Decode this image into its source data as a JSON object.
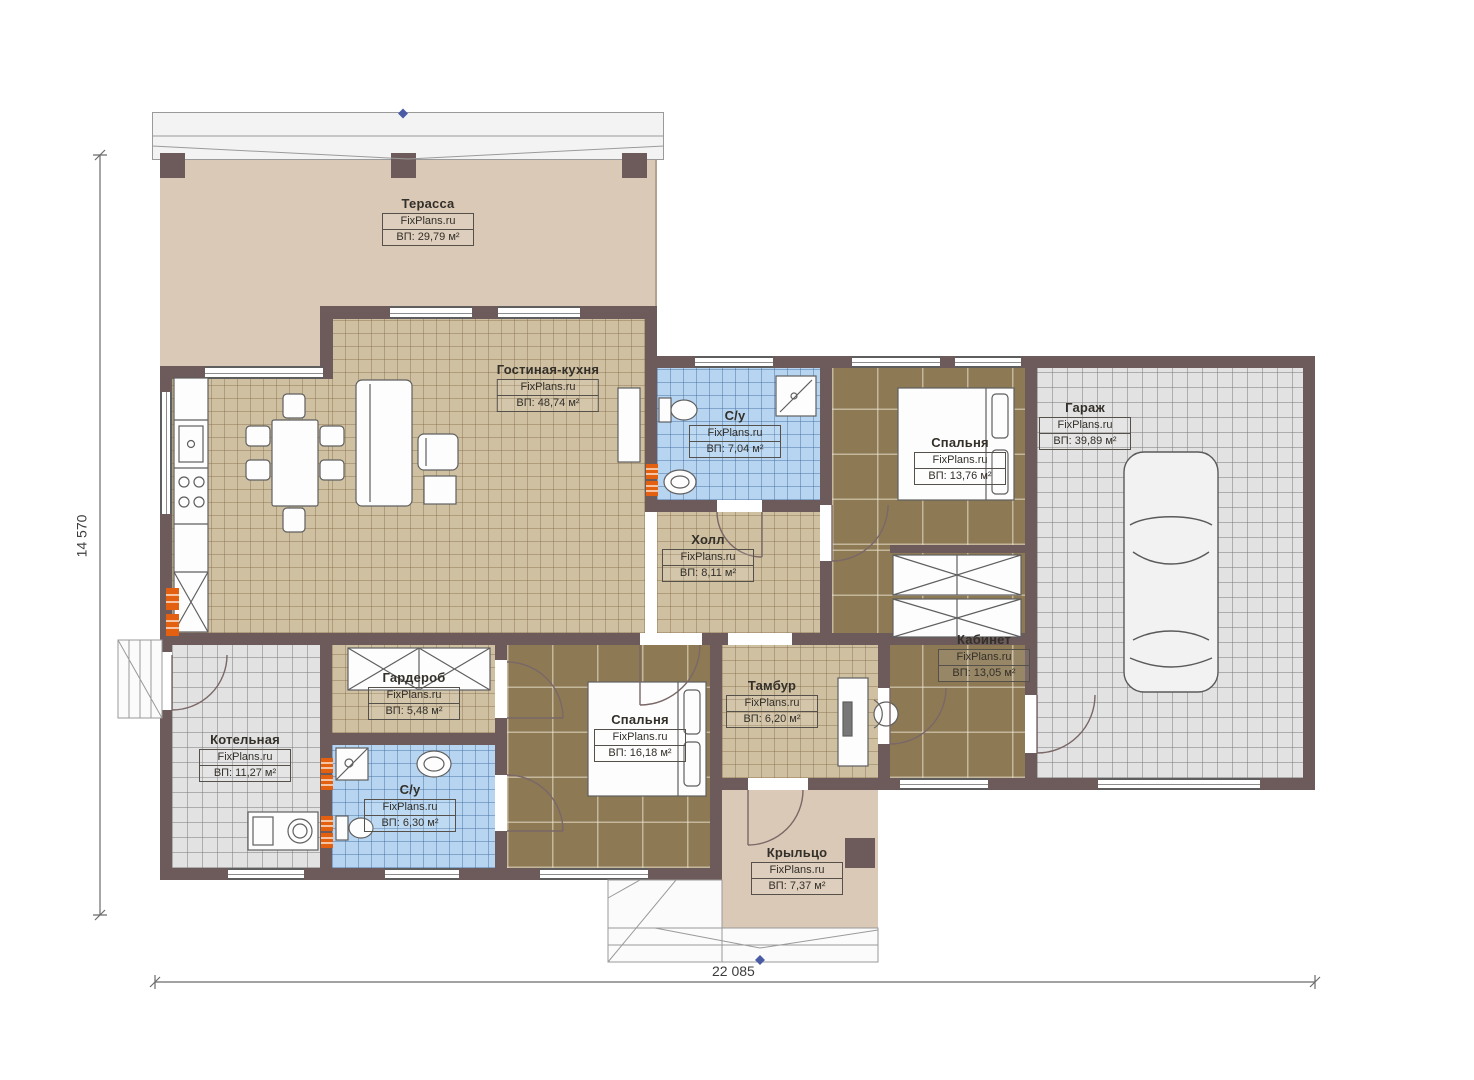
{
  "plan": {
    "watermark": "FixPlans.ru",
    "rooms": [
      {
        "id": "terrace",
        "name": "Терасса",
        "area": "ВП: 29,79 м²"
      },
      {
        "id": "living",
        "name": "Гостиная-кухня",
        "area": "ВП: 48,74 м²"
      },
      {
        "id": "bath1",
        "name": "С/у",
        "area": "ВП: 7,04 м²"
      },
      {
        "id": "bedroom1",
        "name": "Спальня",
        "area": "ВП: 13,76 м²"
      },
      {
        "id": "garage",
        "name": "Гараж",
        "area": "ВП: 39,89 м²"
      },
      {
        "id": "hall",
        "name": "Холл",
        "area": "ВП: 8,11 м²"
      },
      {
        "id": "wardrobe",
        "name": "Гардероб",
        "area": "ВП: 5,48 м²"
      },
      {
        "id": "boiler",
        "name": "Котельная",
        "area": "ВП: 11,27 м²"
      },
      {
        "id": "bath2",
        "name": "С/у",
        "area": "ВП: 6,30 м²"
      },
      {
        "id": "bedroom2",
        "name": "Спальня",
        "area": "ВП: 16,18 м²"
      },
      {
        "id": "tambour",
        "name": "Тамбур",
        "area": "ВП: 6,20 м²"
      },
      {
        "id": "office",
        "name": "Кабинет",
        "area": "ВП: 13,05 м²"
      },
      {
        "id": "porch",
        "name": "Крыльцо",
        "area": "ВП: 7,37 м²"
      }
    ],
    "dimensions": {
      "height_label": "14 570",
      "width_label": "22 085"
    },
    "colors": {
      "wall": "#6d5a5a",
      "floor_tan": "#cfc0a2",
      "floor_dark": "#8d7a55",
      "floor_blue": "#b7d5f1",
      "floor_gray": "#e2e2e2",
      "floor_beige": "#dac9b6",
      "radiator": "#e2600f",
      "marker_blue": "#4a5ba6"
    }
  }
}
